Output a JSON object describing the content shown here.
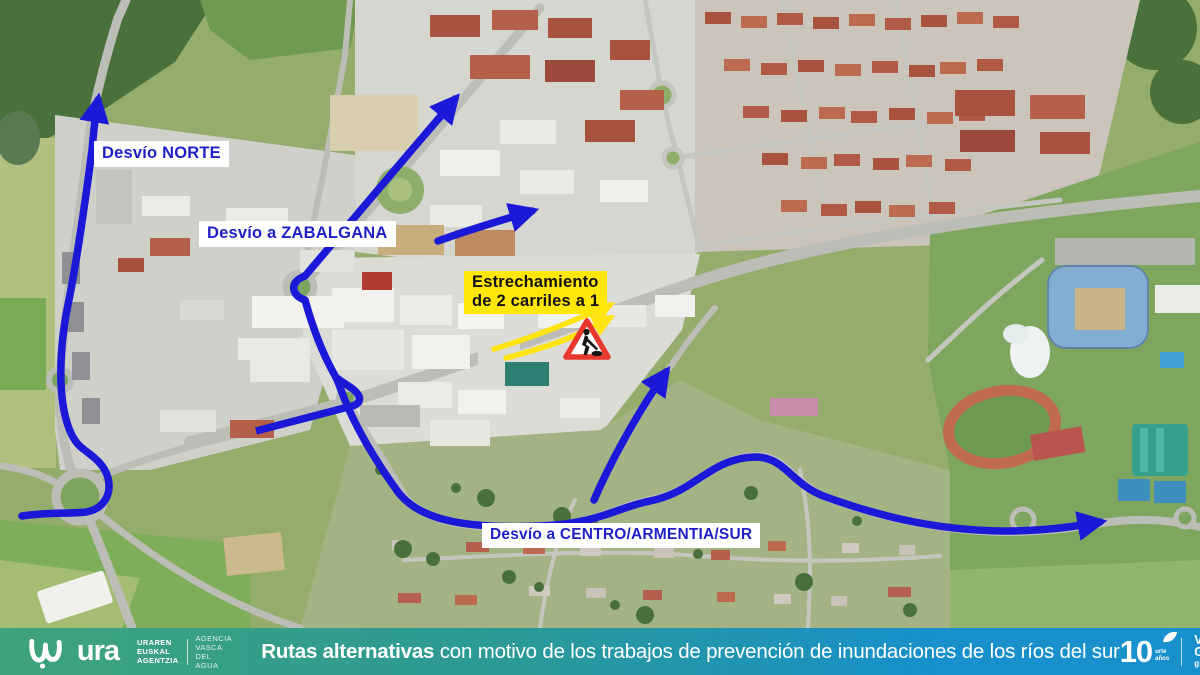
{
  "theme": {
    "route-blue": "#1b18d8",
    "arrow-yellow": "#ffe312",
    "label-blue": "#1f1fc6",
    "label-yellow-bg": "#ffe70a",
    "sign-red": "#e8372c",
    "footer-left": "#3fa37b",
    "footer-right": "#1790cb"
  },
  "map": {
    "labels": {
      "norte": "Desvío NORTE",
      "zabalgana": "Desvío a ZABALGANA",
      "estrechamiento": [
        "Estrechamiento",
        "de 2 carriles a 1"
      ],
      "centro": "Desvío a CENTRO/ARMENTIA/SUR"
    },
    "icons": {
      "roadworks_sign": "roadworks-warning-triangle"
    }
  },
  "footer": {
    "agency": {
      "logo": "ura",
      "basque": [
        "URAREN",
        "EUSKAL",
        "AGENTZIA"
      ],
      "spanish": [
        "AGENCIA",
        "VASCA",
        "DEL AGUA"
      ]
    },
    "message": {
      "bold": "Rutas alternativas",
      "rest": " con motivo de los trabajos de prevención de inundaciones de los ríos del sur"
    },
    "anniversary": {
      "number": "10",
      "unit1": "urte",
      "unit2": "años"
    },
    "city": {
      "name1": "VITORIA",
      "name2": "GASTEIZ",
      "bang": "!",
      "tagline": "green capital"
    }
  }
}
